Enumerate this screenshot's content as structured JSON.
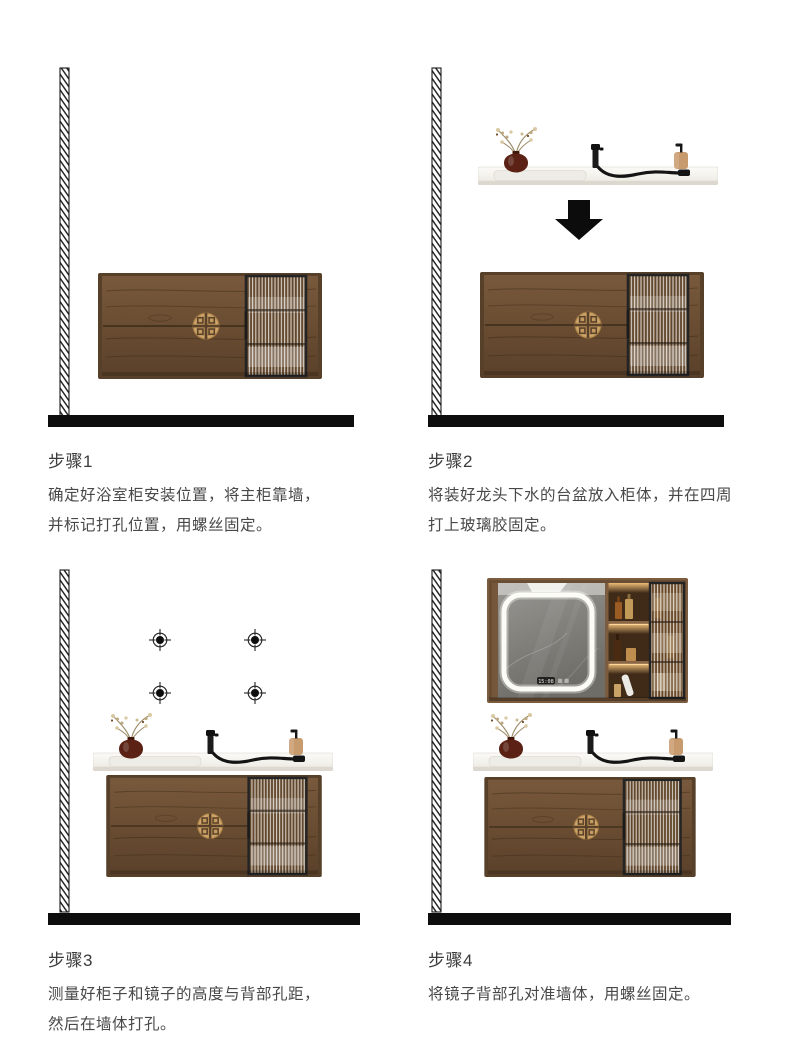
{
  "page": {
    "background": "#ffffff",
    "type": "installation-guide"
  },
  "colors": {
    "wood": "#6b4e33",
    "wood_frame": "#56402a",
    "gold_medallion": "#c59a5f",
    "glass_door_frame": "#242424",
    "countertop": "#f1efe9",
    "vase": "#5a2114",
    "soap_bottle": "#c89b6e",
    "faucet": "#1b1b1b",
    "floor": "#0d0d0d",
    "shelf_glow": "#f5c27c"
  },
  "icons": {
    "down_arrow": "filled-down-arrow",
    "drill_mark": "crosshair-target",
    "wall": "diagonal-hatch-strip"
  },
  "steps": [
    {
      "label": "步骤1",
      "lines": [
        "确定好浴室柜安装位置，将主柜靠墙，",
        "并标记打孔位置，用螺丝固定。"
      ]
    },
    {
      "label": "步骤2",
      "lines": [
        "将装好龙头下水的台盆放入柜体，并在四周",
        "打上玻璃胶固定。"
      ]
    },
    {
      "label": "步骤3",
      "lines": [
        "测量好柜子和镜子的高度与背部孔距，",
        "然后在墙体打孔。"
      ]
    },
    {
      "label": "步骤4",
      "lines": [
        "将镜子背部孔对准墙体，用螺丝固定。"
      ],
      "mirror_time": "15:08"
    }
  ]
}
